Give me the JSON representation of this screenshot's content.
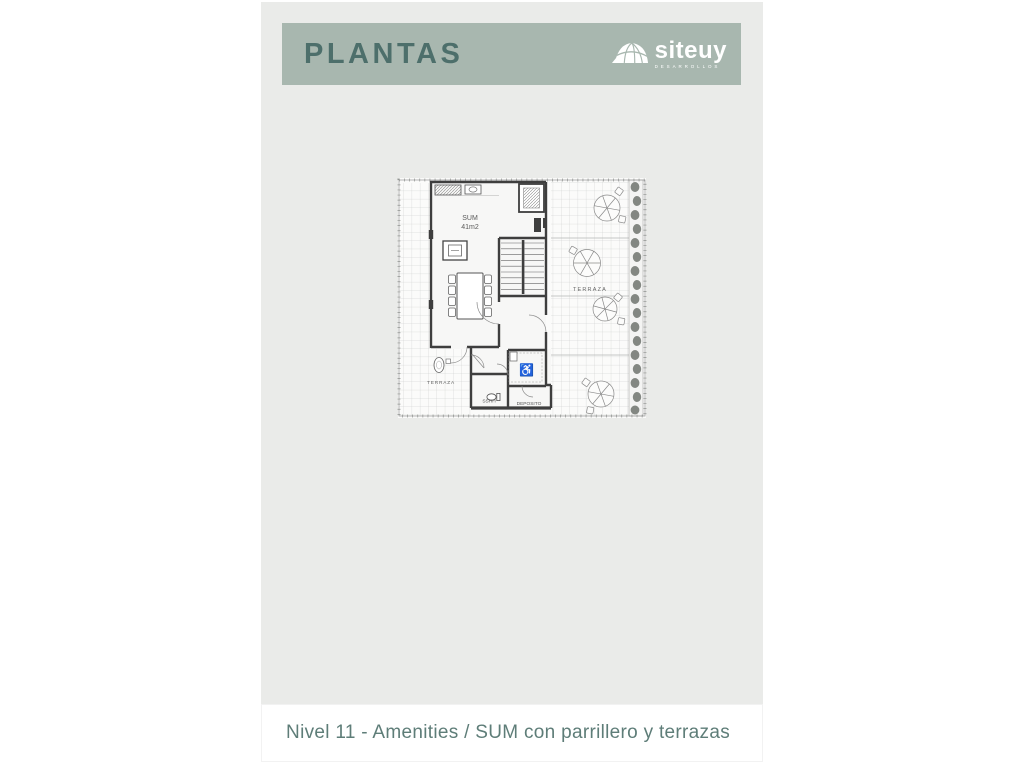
{
  "header": {
    "title": "PLANTAS",
    "bar_color": "#a8b7af",
    "title_color": "#4d6f6b",
    "logo": {
      "brand": "siteuy",
      "tagline": "DESARROLLOS",
      "icon": "dome-shell-icon",
      "color": "#ffffff"
    }
  },
  "floorplan": {
    "labels": {
      "sum_room": "SUM",
      "sum_area": "41m2",
      "terrace_right": "TERRAZA",
      "terrace_left": "TERRAZA",
      "bathroom": "SSHH",
      "storage": "DEPOSITO"
    },
    "accessible_icon": "♿"
  },
  "footer": {
    "caption": "Nivel 11 - Amenities / SUM con parrillero y terrazas",
    "text_color": "#5e7d78",
    "background": "#ffffff"
  },
  "colors": {
    "page_background": "#ffffff",
    "card_background": "#eaebe9",
    "wall": "#3e3e3e",
    "plan_line": "#8a8a8a"
  }
}
